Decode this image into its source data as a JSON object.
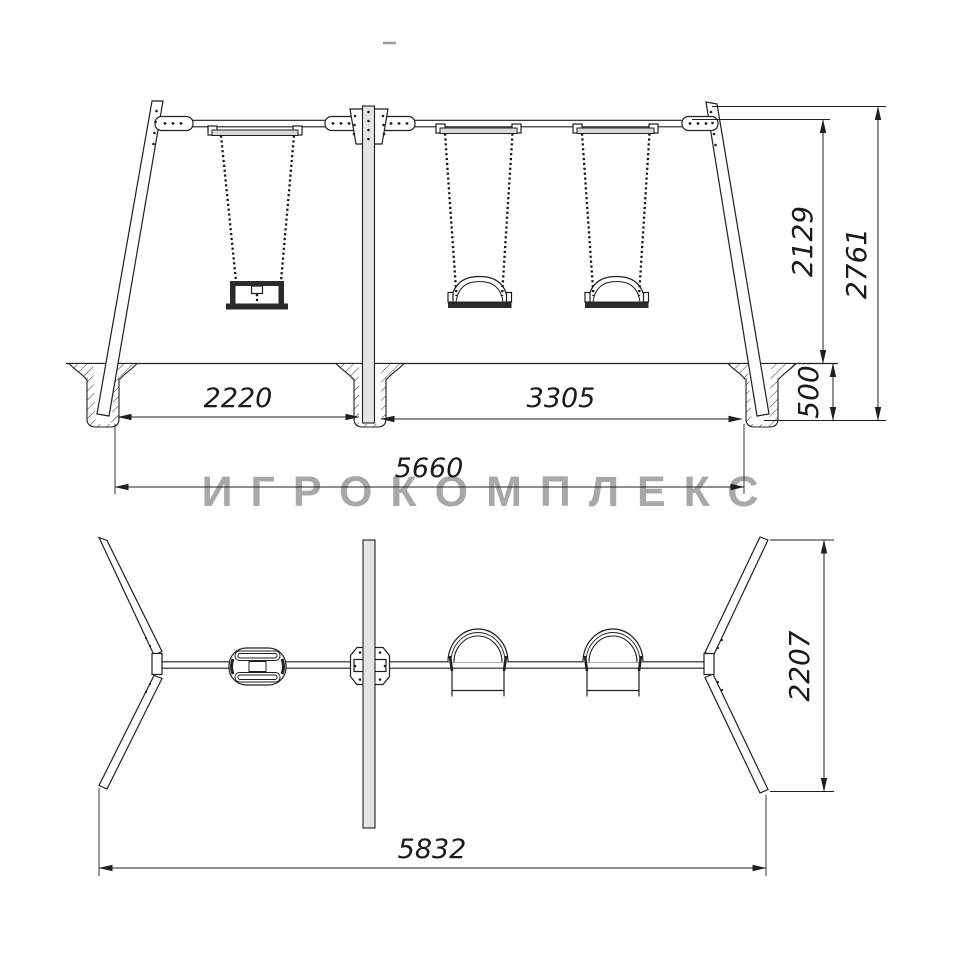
{
  "watermark": {
    "text": "ИГРОКОМПЛЕКС",
    "color": "#a8a8a8"
  },
  "dims": {
    "front_span_left": "2220",
    "front_span_right": "3305",
    "front_total_width": "5660",
    "front_beam_height": "2129",
    "front_total_height": "2761",
    "front_foundation_depth": "500",
    "plan_total_width": "5832",
    "plan_leg_spread": "2207"
  },
  "colors": {
    "line": "#1f1f1f",
    "watermark": "#a8a8a8",
    "light_fill": "#e4e4e4"
  }
}
